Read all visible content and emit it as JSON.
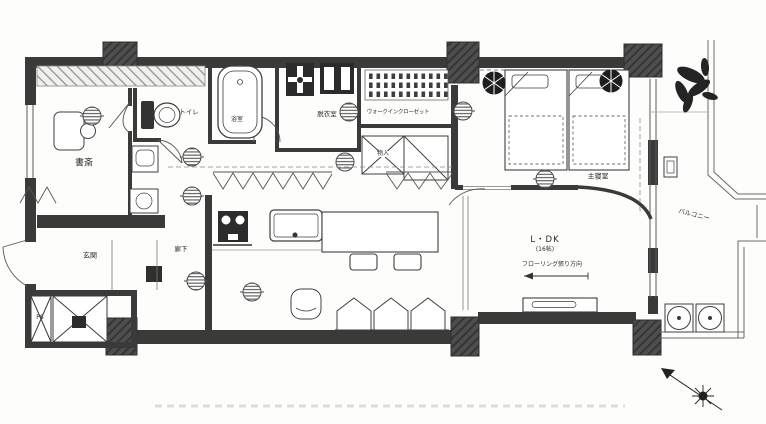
{
  "plan": {
    "labels": {
      "study": "書斎",
      "toilet": "トイレ",
      "bath": "浴室",
      "washroom": "脱衣室",
      "walk_in_closet": "ウォークインクローゼット",
      "storage": "物入",
      "hallway": "廊下",
      "entrance": "玄関",
      "pipe_space": "PS",
      "ldk": "L・DK",
      "ldk_size": "(16帖)",
      "flooring_note": "フローリング張り方向",
      "master_bedroom": "主寝室",
      "balcony": "バルコニー"
    },
    "colors": {
      "wall": "#3a3a3a",
      "line": "#3f3f3f",
      "paper": "#ffffff",
      "hatch": "#9a9a96"
    }
  }
}
